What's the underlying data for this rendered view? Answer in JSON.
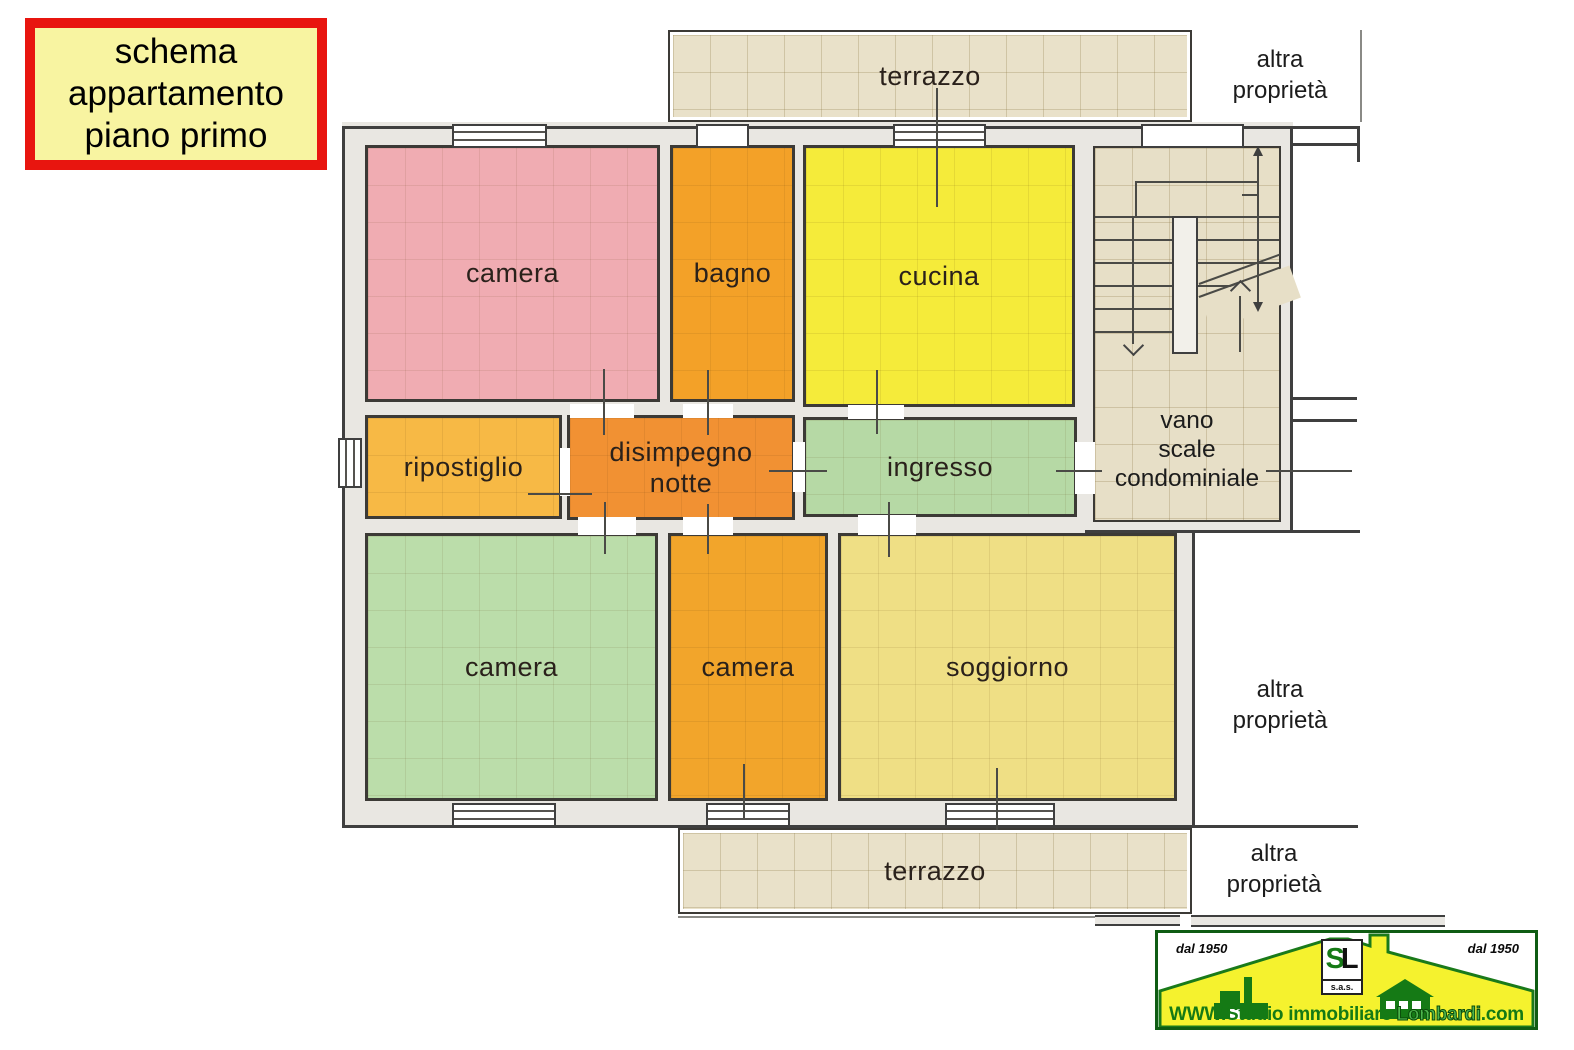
{
  "title_box": {
    "lines": [
      "schema",
      "appartamento",
      "piano primo"
    ],
    "bg_color": "#f8f4a1",
    "border_color": "#e8150f"
  },
  "plan": {
    "wall_fill": "#e9e7e2",
    "wall_line": "#3f3f3f",
    "rooms": [
      {
        "id": "camera-nord",
        "label": "camera",
        "color": "#f0acb2"
      },
      {
        "id": "bagno",
        "label": "bagno",
        "color": "#f3a128"
      },
      {
        "id": "cucina",
        "label": "cucina",
        "color": "#f5eb3a"
      },
      {
        "id": "ripostiglio",
        "label": "ripostiglio",
        "color": "#f7b945"
      },
      {
        "id": "disimpegno-notte",
        "label_lines": [
          "disimpegno",
          "notte"
        ],
        "color": "#f19133"
      },
      {
        "id": "ingresso",
        "label": "ingresso",
        "color": "#b6d9a5"
      },
      {
        "id": "camera-ovest",
        "label": "camera",
        "color": "#bbddaa"
      },
      {
        "id": "camera-sud",
        "label": "camera",
        "color": "#f2a52b"
      },
      {
        "id": "soggiorno",
        "label": "soggiorno",
        "color": "#efdf85"
      }
    ],
    "terraces": [
      {
        "id": "terrazzo-nord",
        "label": "terrazzo",
        "color": "#e9e1c9"
      },
      {
        "id": "terrazzo-sud",
        "label": "terrazzo",
        "color": "#e9e1c9"
      }
    ],
    "stairwell": {
      "label_lines": [
        "vano",
        "scale",
        "condominiale"
      ],
      "color": "#e7dfc7"
    },
    "other_property": {
      "line1": "altra",
      "line2": "proprietà"
    }
  },
  "logo": {
    "established_left": "dal 1950",
    "established_right": "dal 1950",
    "monogram_s": "S",
    "monogram_l": "L",
    "company_type": "s.a.s.",
    "website_prefix": "WWW.Studio immobiliare ",
    "website_brand": "Lombardi",
    "website_suffix": ".com",
    "roof_color": "#f5f22e",
    "green": "#157a15"
  }
}
